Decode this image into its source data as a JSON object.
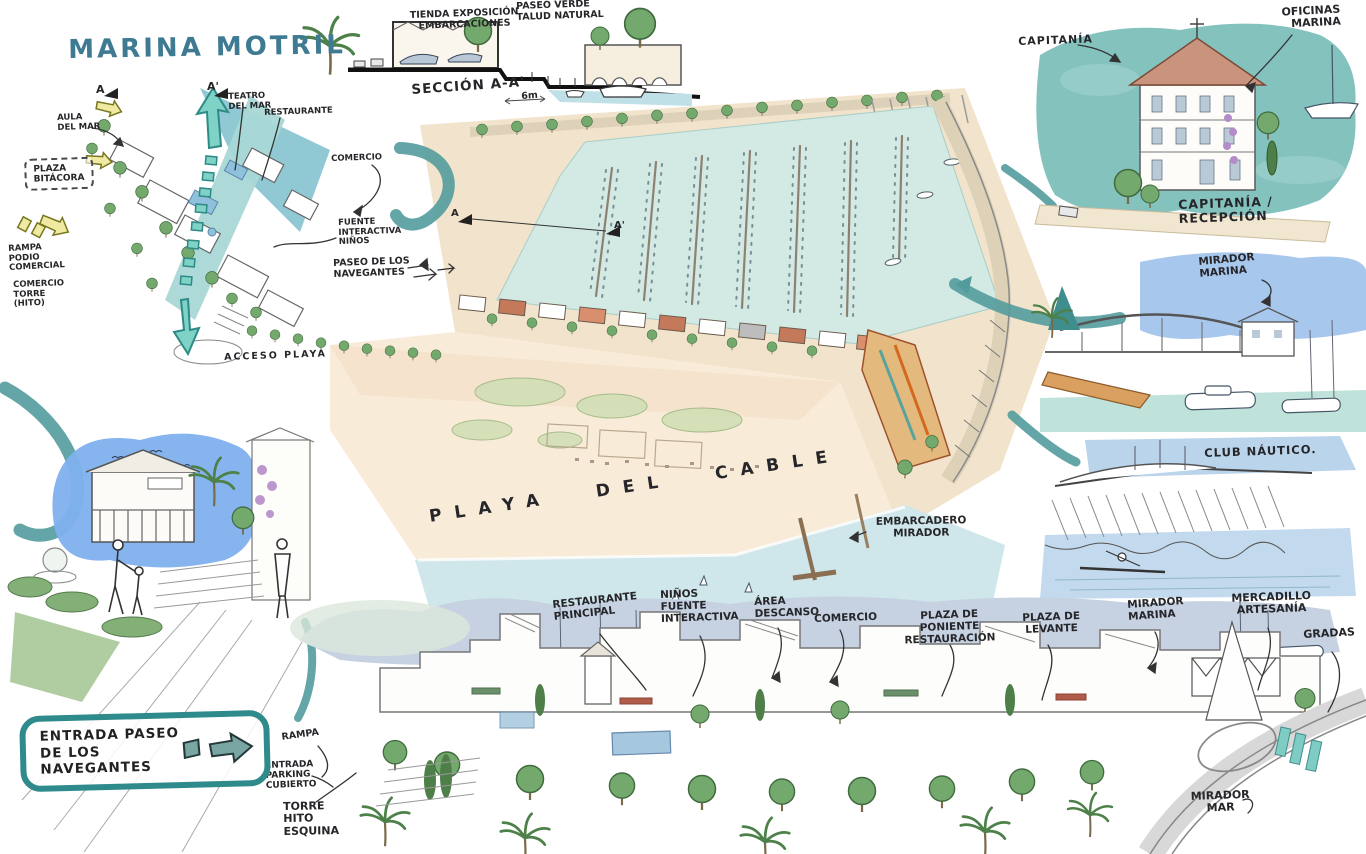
{
  "title": "MARINA MOTRIL",
  "entry_box": {
    "line1": "ENTRADA PASEO",
    "line2": "DE LOS NAVEGANTES"
  },
  "palette": {
    "title_teal": "#3e7a92",
    "box_teal": "#2f8a8b",
    "swoosh_teal": "#539c9d",
    "marina_water": "#d2e9e4",
    "sea": "#cfe6ea",
    "beach": "#f8ecd8",
    "sky_blue": "#7fb0ee",
    "panorama_sky": "#c6d2e2",
    "tree_green": "#74a96d",
    "roof_terracotta": "#c4795a",
    "ink": "#26262a"
  },
  "annotations": [
    {
      "name": "title",
      "cls": "title",
      "text": "MARINA MOTRIL",
      "x": 68,
      "y": 36,
      "s": 26,
      "r": -1,
      "c": "#3e7a92"
    },
    {
      "name": "section-mark-a-inset",
      "text": "A",
      "x": 96,
      "y": 84,
      "s": 11,
      "r": 0
    },
    {
      "name": "section-mark-a2-inset",
      "text": "A'",
      "x": 207,
      "y": 81,
      "s": 11,
      "r": 0
    },
    {
      "name": "aula-del-mar",
      "text": "AULA\nDEL MAR",
      "x": 57,
      "y": 114,
      "s": 8.5,
      "r": -2
    },
    {
      "name": "teatro-del-mar",
      "text": "TEATRO\nDEL MAR",
      "x": 228,
      "y": 93,
      "s": 8.5,
      "r": -2
    },
    {
      "name": "restaurante",
      "text": "RESTAURANTE",
      "x": 264,
      "y": 109,
      "s": 8.5,
      "r": -2
    },
    {
      "name": "plaza-bitacora",
      "cls": "boxed",
      "text": "PLAZA\nBITÁCORA",
      "x": 24,
      "y": 159,
      "s": 9,
      "r": -2
    },
    {
      "name": "rampa-podio-comercial",
      "text": "RAMPA\nPODIO\nCOMERCIAL",
      "x": 8,
      "y": 245,
      "s": 8.5,
      "r": -3
    },
    {
      "name": "comercio-torre-hito",
      "text": "COMERCIO\nTORRE\n(HITO)",
      "x": 13,
      "y": 281,
      "s": 8.5,
      "r": -2
    },
    {
      "name": "acceso-playa",
      "text": "ACCESO PLAYA",
      "x": 224,
      "y": 353,
      "s": 9.5,
      "r": -2,
      "ls": 2
    },
    {
      "name": "comercio-left",
      "text": "COMERCIO",
      "x": 331,
      "y": 155,
      "s": 8.5,
      "r": -2
    },
    {
      "name": "fuente-interactiva-ninos",
      "text": "FUENTE\nINTERACTIVA\nNIÑOS",
      "x": 338,
      "y": 219,
      "s": 8.5,
      "r": -2
    },
    {
      "name": "paseo-de-los-navegantes",
      "text": "PASEO DE LOS\nNAVEGANTES",
      "x": 333,
      "y": 259,
      "s": 9.5,
      "r": -2
    },
    {
      "name": "tienda-exposicion",
      "text": "TIENDA EXPOSICIÓN\nEMBARCACIONES",
      "x": 409,
      "y": 11,
      "s": 9.5,
      "r": -2,
      "w": 110,
      "ta": "center"
    },
    {
      "name": "paseo-verde",
      "text": "PASEO VERDE\nTALUD NATURAL",
      "x": 516,
      "y": 2,
      "s": 9.5,
      "r": -2
    },
    {
      "name": "seccion-aa",
      "text": "SECCIÓN A-A'",
      "x": 411,
      "y": 83,
      "s": 13.5,
      "r": -4,
      "ls": 1
    },
    {
      "name": "dim-6m",
      "text": "6m",
      "x": 521,
      "y": 92,
      "s": 9.5,
      "r": -4
    },
    {
      "name": "section-mark-a-plan",
      "text": "A",
      "x": 451,
      "y": 208,
      "s": 10,
      "r": 0
    },
    {
      "name": "section-mark-a2-plan",
      "text": "A'",
      "x": 614,
      "y": 220,
      "s": 10,
      "r": 0
    },
    {
      "name": "capitania",
      "text": "CAPITANÍA",
      "x": 1018,
      "y": 36,
      "s": 11,
      "r": -2,
      "ls": 1
    },
    {
      "name": "oficinas-marina",
      "text": "OFICINAS\nMARINA",
      "x": 1274,
      "y": 7,
      "s": 11,
      "r": -3,
      "ta": "right",
      "w": 66
    },
    {
      "name": "capitania-recepcion",
      "text": "CAPITANÍA / RECEPCIÓN",
      "x": 1178,
      "y": 198,
      "s": 12.5,
      "r": -2,
      "ls": 1
    },
    {
      "name": "mirador-marina-right",
      "text": "MIRADOR\nMARINA",
      "x": 1198,
      "y": 257,
      "s": 10.5,
      "r": -5
    },
    {
      "name": "club-nautico",
      "text": "CLUB NÁUTICO.",
      "x": 1204,
      "y": 447,
      "s": 11.5,
      "r": -2,
      "ls": 1
    },
    {
      "name": "playa-del-cable",
      "text": "PLAYA DEL CABLE",
      "x": 428,
      "y": 508,
      "s": 17,
      "r": -8.5,
      "ls": 13,
      "ws": 26
    },
    {
      "name": "embarcadero-mirador",
      "text": "EMBARCADERO\nMIRADOR",
      "x": 866,
      "y": 517,
      "s": 10.5,
      "r": -1,
      "w": 110,
      "ta": "center"
    },
    {
      "name": "restaurante-principal",
      "text": "RESTAURANTE\nPRINCIPAL",
      "x": 552,
      "y": 600,
      "s": 10.5,
      "r": -6
    },
    {
      "name": "ninos-fuente-interactiva",
      "text": "NIÑOS\nFUENTE\nINTERACTIVA",
      "x": 660,
      "y": 590,
      "s": 10.5,
      "r": -2
    },
    {
      "name": "area-descanso",
      "text": "ÁREA\nDESCANSO",
      "x": 754,
      "y": 597,
      "s": 10.5,
      "r": -2
    },
    {
      "name": "comercio-bottom",
      "text": "COMERCIO",
      "x": 814,
      "y": 614,
      "s": 10.5,
      "r": -2
    },
    {
      "name": "plaza-de-poniente",
      "text": "PLAZA DE PONIENTE\nRESTAURACIÓN",
      "x": 890,
      "y": 612,
      "s": 10.5,
      "r": -2,
      "w": 118,
      "ta": "center"
    },
    {
      "name": "plaza-de-levante",
      "text": "PLAZA DE\nLEVANTE",
      "x": 1022,
      "y": 613,
      "s": 10.5,
      "r": -2,
      "w": 58,
      "ta": "center"
    },
    {
      "name": "mirador-marina-bottom",
      "text": "MIRADOR\nMARINA",
      "x": 1127,
      "y": 600,
      "s": 10.5,
      "r": -4
    },
    {
      "name": "mercadillo-artesania",
      "text": "MERCADILLO\nARTESANÍA",
      "x": 1224,
      "y": 593,
      "s": 11,
      "r": -2,
      "w": 94,
      "ta": "center"
    },
    {
      "name": "gradas",
      "text": "GRADAS",
      "x": 1303,
      "y": 629,
      "s": 11,
      "r": -3
    },
    {
      "name": "mirador-mar",
      "text": "MIRADOR\nMAR",
      "x": 1188,
      "y": 791,
      "s": 11,
      "r": -2,
      "w": 64,
      "ta": "center"
    },
    {
      "name": "rampa-bottom",
      "text": "RAMPA",
      "x": 281,
      "y": 733,
      "s": 9.5,
      "r": -8
    },
    {
      "name": "entrada-parking-cubierto",
      "text": "ENTRADA\nPARKING\nCUBIERTO",
      "x": 265,
      "y": 761,
      "s": 9,
      "r": -2
    },
    {
      "name": "torre-hito-esquina",
      "text": "TORRE\nHITO\nESQUINA",
      "x": 283,
      "y": 801,
      "s": 11,
      "r": -1
    }
  ]
}
